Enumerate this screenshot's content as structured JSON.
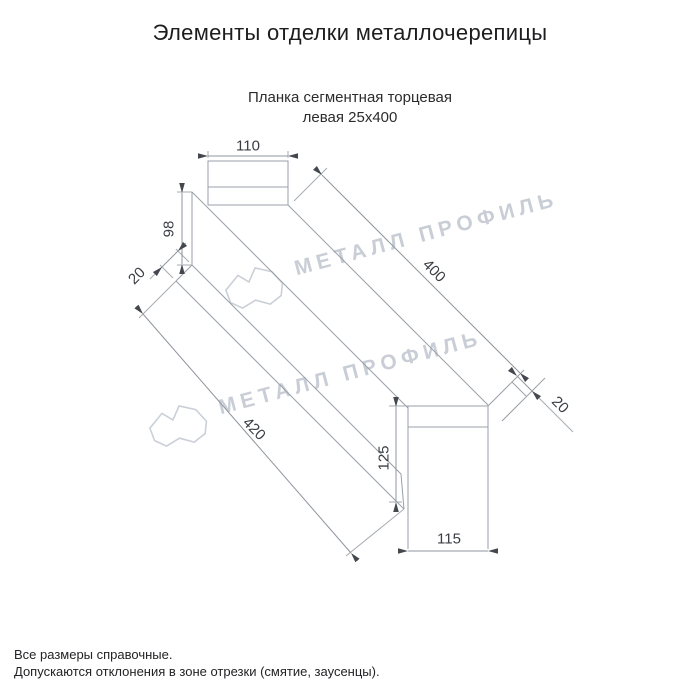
{
  "page": {
    "title": "Элементы отделки металлочерепицы",
    "subtitle_line1": "Планка сегментная торцевая",
    "subtitle_line2": "левая 25х400",
    "footnote_line1": "Все размеры справочные.",
    "footnote_line2": "Допускаются отклонения в зоне отрезки (смятие, заусенцы)."
  },
  "watermark": {
    "text": "МЕТАЛЛ ПРОФИЛЬ",
    "color": "#c9ced6"
  },
  "drawing": {
    "part_name": "Планка сегментная торцевая левая",
    "profile_size": "25х400",
    "line_color": "#9aa0a8",
    "text_color": "#3a3e44",
    "dimensions": {
      "top_flange_width": "110",
      "left_end_height": "98",
      "left_hem": "20",
      "top_edge_length": "400",
      "bottom_edge_length": "420",
      "right_hem": "20",
      "bottom_end_height": "125",
      "bottom_end_width": "115"
    }
  }
}
